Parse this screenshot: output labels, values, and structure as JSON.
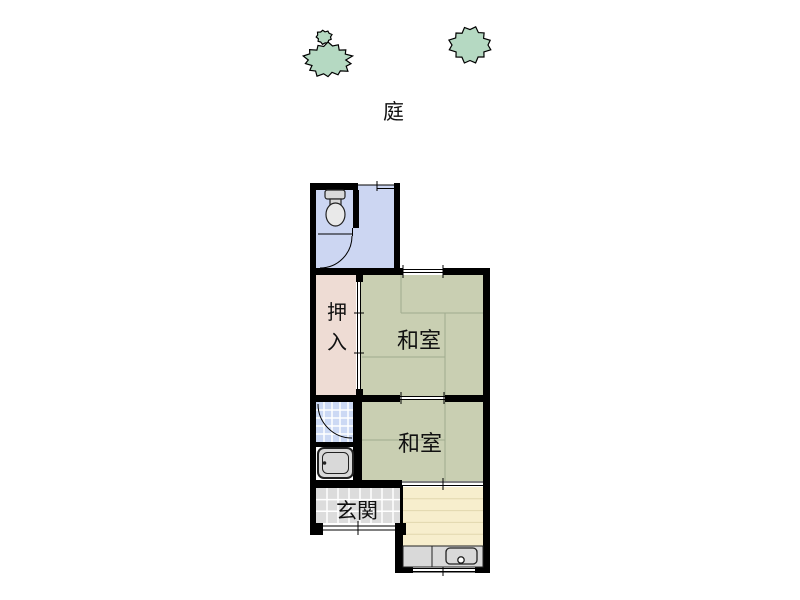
{
  "plan": {
    "garden_label": "庭",
    "rooms": {
      "toilet": {
        "floor": "#ccd6f2"
      },
      "bathroom": {
        "floor": "#ccd9f4"
      },
      "closet": {
        "label": "押入",
        "floor": "#eedcd4"
      },
      "tatami_upper": {
        "label": "和室",
        "floor": "#c9cfb2"
      },
      "tatami_lower": {
        "label": "和室",
        "floor": "#c9cfb2"
      },
      "entrance": {
        "label": "玄関",
        "floor": "#dcdcdc"
      },
      "kitchen": {
        "floor": "#f7eecd"
      }
    },
    "colors": {
      "wall": "#000000",
      "tree": "#b5d9c2",
      "fixture": "#d9d9d9",
      "fixture_light": "#e9e9e9",
      "tatami_line": "#a0ab8e",
      "kitchen_line": "#e2d7ae",
      "text": "#111111"
    },
    "icons": [
      "bush-icon",
      "bush-icon",
      "toilet-icon",
      "bathtub-icon",
      "kitchen-sink-icon"
    ]
  }
}
